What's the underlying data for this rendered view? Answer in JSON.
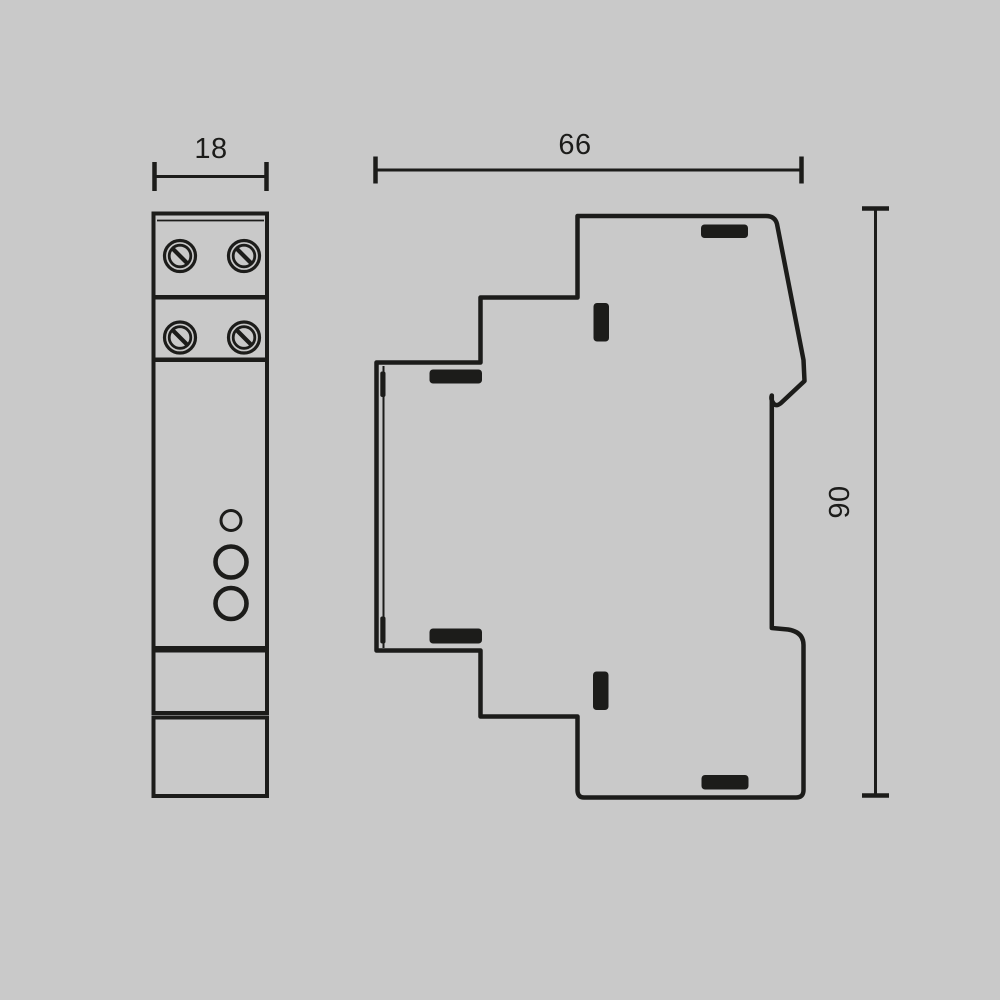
{
  "colors": {
    "background": "#c9c9c9",
    "ink": "#1c1c1a"
  },
  "dimensions": {
    "front_width": "18",
    "side_depth": "66",
    "side_height": "90"
  },
  "front_view": {
    "terminal_screw_count": 4,
    "indicator_led_count": 1,
    "button_count": 2,
    "section_count": 5
  },
  "side_view": {
    "vent_slot_count": 6,
    "din_rail_tick_count": 2
  }
}
